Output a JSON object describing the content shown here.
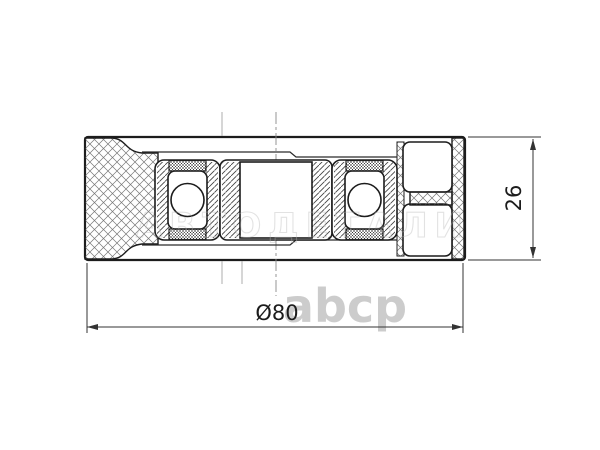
{
  "drawing": {
    "title": "pulley-cross-section",
    "dimensions": {
      "diameter_label": "Ø80",
      "width_label": "26"
    },
    "watermark": {
      "center_text": "АВТОДЕТАЛИ",
      "logo_text": "abcp"
    },
    "colors": {
      "line": "#1c1c1c",
      "dimension": "#333333",
      "watermark_outline": "#b5b5b5",
      "logo_gray": "#bcbcbc"
    }
  }
}
